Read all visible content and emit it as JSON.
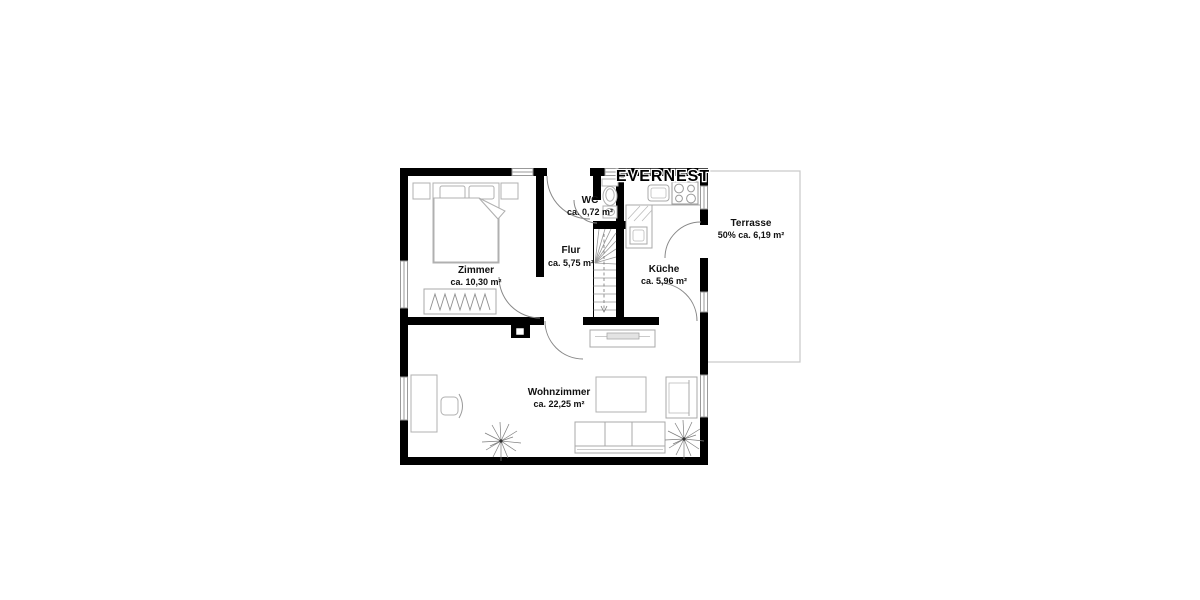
{
  "watermark": "EVERNEST",
  "rooms": [
    {
      "name": "Zimmer",
      "area": "ca. 10,30 m²"
    },
    {
      "name": "WC",
      "area": "ca. 0,72 m²"
    },
    {
      "name": "Flur",
      "area": "ca. 5,75 m²"
    },
    {
      "name": "Küche",
      "area": "ca. 5,96 m²"
    },
    {
      "name": "Terrasse",
      "area": "50% ca. 6,19 m²"
    },
    {
      "name": "Wohnzimmer",
      "area": "ca. 22,25 m²"
    }
  ],
  "colors": {
    "wall": "#000000",
    "furniture_outline": "#b0b0b0",
    "door_arc": "#888888",
    "window_frame": "#999999",
    "terrace_outline": "#cccccc",
    "background": "#ffffff"
  }
}
